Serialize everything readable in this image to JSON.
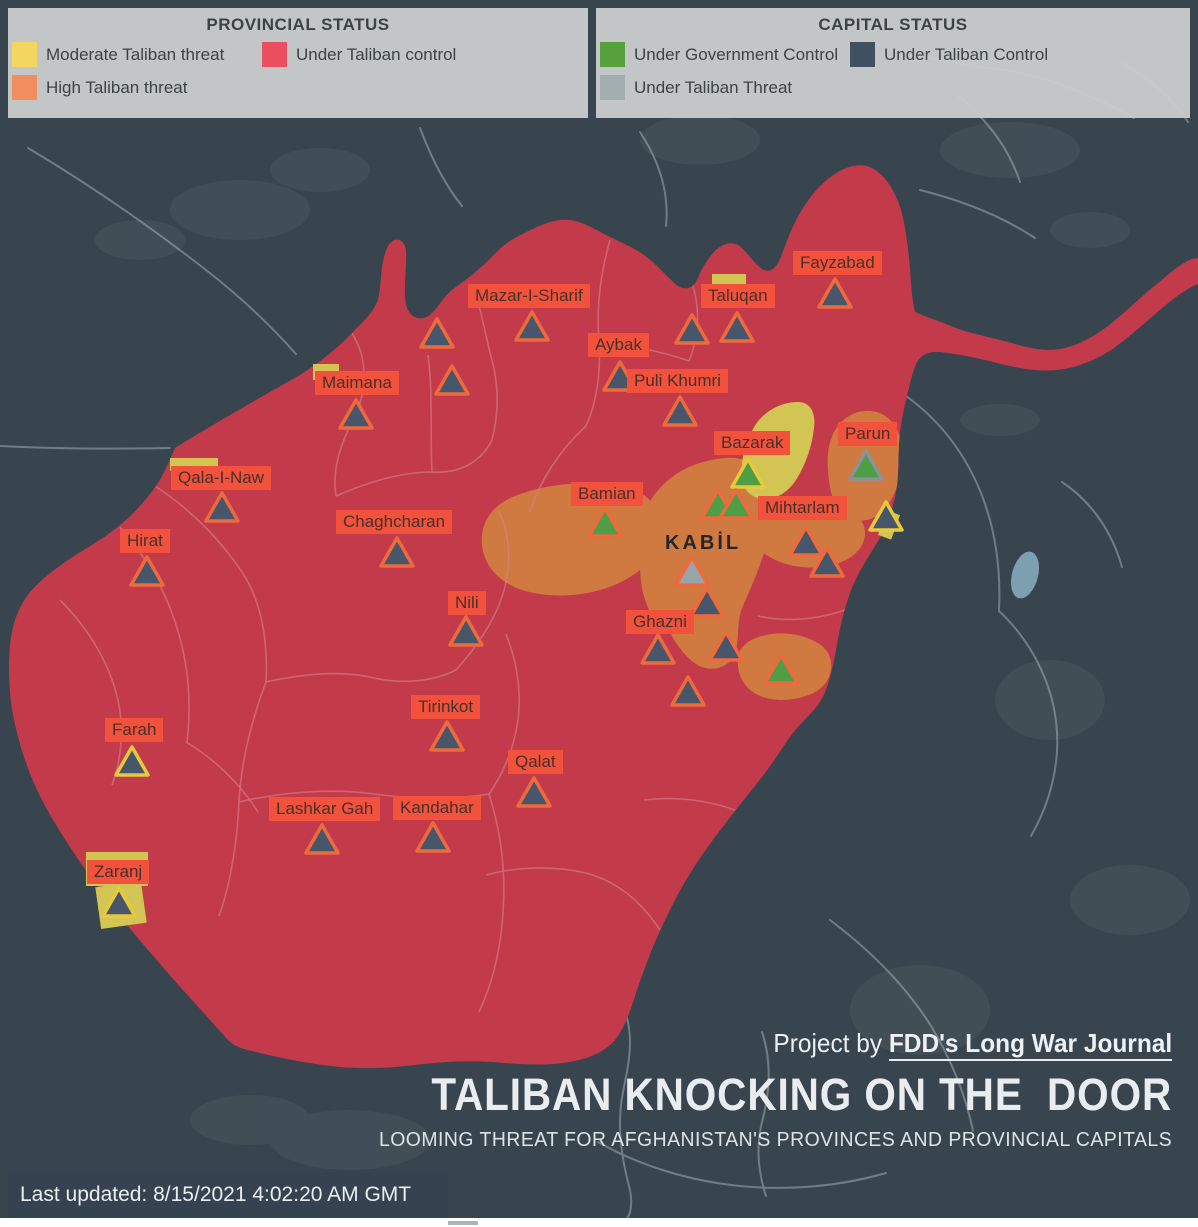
{
  "legend": {
    "provincial": {
      "title": "PROVINCIAL STATUS",
      "items": [
        {
          "label": "Moderate Taliban threat",
          "color": "#f3d65f"
        },
        {
          "label": "High Taliban threat",
          "color": "#f28d60"
        },
        {
          "label": "Under Taliban control",
          "color": "#e94f5e"
        }
      ]
    },
    "capital": {
      "title": "CAPITAL STATUS",
      "items": [
        {
          "label": "Under Government Control",
          "color": "#57a13d"
        },
        {
          "label": "Under Taliban Threat",
          "color": "#a3aeb1"
        },
        {
          "label": "Under Taliban Control",
          "color": "#3f5160"
        }
      ]
    }
  },
  "map": {
    "colors": {
      "background": "#39454e",
      "under_taliban_control_province": "#c33b4b",
      "high_threat_province": "#d07940",
      "moderate_threat_province": "#d2c553",
      "label_bg": "#f2513c",
      "label_text": "#46312b",
      "marker_taliban": "#47566a",
      "marker_government": "#4d9e45",
      "marker_threat": "#98a6ac",
      "outline_orange": "#ed6a3d",
      "outline_yellow": "#e7c93e",
      "outline_gray": "#8a9298"
    },
    "labels": [
      {
        "text": "Fayzabad",
        "x": 793,
        "y": 251
      },
      {
        "text": "Taluqan",
        "x": 701,
        "y": 284
      },
      {
        "text": "Mazar-I-Sharif",
        "x": 468,
        "y": 284
      },
      {
        "text": "Aybak",
        "x": 588,
        "y": 333
      },
      {
        "text": "Puli Khumri",
        "x": 627,
        "y": 369
      },
      {
        "text": "Maimana",
        "x": 315,
        "y": 371
      },
      {
        "text": "Bazarak",
        "x": 714,
        "y": 431
      },
      {
        "text": "Parun",
        "x": 838,
        "y": 422
      },
      {
        "text": "Qala-I-Naw",
        "x": 171,
        "y": 466
      },
      {
        "text": "Bamian",
        "x": 571,
        "y": 482
      },
      {
        "text": "Chaghcharan",
        "x": 336,
        "y": 510
      },
      {
        "text": "Mihtarlam",
        "x": 758,
        "y": 496
      },
      {
        "text": "Hirat",
        "x": 120,
        "y": 529
      },
      {
        "text": "KABİL",
        "x": 665,
        "y": 533,
        "plain": true
      },
      {
        "text": "Nili",
        "x": 448,
        "y": 591
      },
      {
        "text": "Ghazni",
        "x": 626,
        "y": 610
      },
      {
        "text": "Tirinkot",
        "x": 411,
        "y": 695
      },
      {
        "text": "Farah",
        "x": 105,
        "y": 718
      },
      {
        "text": "Qalat",
        "x": 508,
        "y": 750
      },
      {
        "text": "Lashkar Gah",
        "x": 269,
        "y": 797
      },
      {
        "text": "Kandahar",
        "x": 393,
        "y": 796
      },
      {
        "text": "Zaranj",
        "x": 87,
        "y": 860
      }
    ],
    "markers": [
      {
        "id": "fayzabad",
        "x": 835,
        "y": 278,
        "status": "taliban",
        "outline": "orange"
      },
      {
        "id": "capital-marker-1",
        "x": 692,
        "y": 314,
        "status": "taliban",
        "outline": "orange"
      },
      {
        "id": "taluqan",
        "x": 737,
        "y": 312,
        "status": "taliban",
        "outline": "orange"
      },
      {
        "id": "mazar-i-sharif",
        "x": 532,
        "y": 311,
        "status": "taliban",
        "outline": "orange"
      },
      {
        "id": "capital-marker-2",
        "x": 437,
        "y": 318,
        "status": "taliban",
        "outline": "orange"
      },
      {
        "id": "capital-marker-3",
        "x": 452,
        "y": 365,
        "status": "taliban",
        "outline": "orange"
      },
      {
        "id": "aybak",
        "x": 620,
        "y": 361,
        "status": "taliban",
        "outline": "orange"
      },
      {
        "id": "puli-khumri",
        "x": 680,
        "y": 396,
        "status": "taliban",
        "outline": "orange"
      },
      {
        "id": "maimana",
        "x": 356,
        "y": 399,
        "status": "taliban",
        "outline": "orange"
      },
      {
        "id": "qala-i-naw",
        "x": 222,
        "y": 492,
        "status": "taliban",
        "outline": "orange"
      },
      {
        "id": "hirat",
        "x": 147,
        "y": 556,
        "status": "taliban",
        "outline": "orange"
      },
      {
        "id": "chaghcharan",
        "x": 397,
        "y": 537,
        "status": "taliban",
        "outline": "orange"
      },
      {
        "id": "bamian",
        "x": 605,
        "y": 507,
        "status": "government",
        "outline": "orange"
      },
      {
        "id": "bazarak",
        "x": 748,
        "y": 458,
        "status": "government",
        "outline": "yellow"
      },
      {
        "id": "capital-marker-4",
        "x": 718,
        "y": 489,
        "status": "government",
        "outline": "orange"
      },
      {
        "id": "capital-marker-5",
        "x": 736,
        "y": 489,
        "status": "government",
        "outline": "orange"
      },
      {
        "id": "parun",
        "x": 866,
        "y": 450,
        "status": "government",
        "outline": "gray"
      },
      {
        "id": "kabil",
        "x": 692,
        "y": 556,
        "status": "threat",
        "outline": "orange"
      },
      {
        "id": "mihtarlam",
        "x": 806,
        "y": 526,
        "status": "taliban",
        "outline": "orange"
      },
      {
        "id": "capital-marker-6",
        "x": 827,
        "y": 547,
        "status": "taliban",
        "outline": "orange"
      },
      {
        "id": "capital-marker-7",
        "x": 886,
        "y": 501,
        "status": "taliban",
        "outline": "yellow"
      },
      {
        "id": "capital-marker-8",
        "x": 707,
        "y": 587,
        "status": "taliban",
        "outline": "orange"
      },
      {
        "id": "capital-marker-9",
        "x": 726,
        "y": 631,
        "status": "taliban",
        "outline": "orange"
      },
      {
        "id": "ghazni",
        "x": 658,
        "y": 634,
        "status": "taliban",
        "outline": "orange"
      },
      {
        "id": "capital-marker-10",
        "x": 688,
        "y": 676,
        "status": "taliban",
        "outline": "orange"
      },
      {
        "id": "capital-marker-11",
        "x": 781,
        "y": 654,
        "status": "government",
        "outline": "orange"
      },
      {
        "id": "nili",
        "x": 466,
        "y": 616,
        "status": "taliban",
        "outline": "orange"
      },
      {
        "id": "tirinkot",
        "x": 447,
        "y": 721,
        "status": "taliban",
        "outline": "orange"
      },
      {
        "id": "farah",
        "x": 132,
        "y": 746,
        "status": "taliban",
        "outline": "yellow"
      },
      {
        "id": "qalat",
        "x": 534,
        "y": 777,
        "status": "taliban",
        "outline": "orange"
      },
      {
        "id": "lashkar-gah",
        "x": 322,
        "y": 824,
        "status": "taliban",
        "outline": "orange"
      },
      {
        "id": "kandahar",
        "x": 433,
        "y": 822,
        "status": "taliban",
        "outline": "orange"
      },
      {
        "id": "zaranj",
        "x": 119,
        "y": 887,
        "status": "taliban",
        "outline": "yellow"
      }
    ],
    "patches": [
      {
        "x": 712,
        "y": 274,
        "w": 34,
        "h": 16,
        "r": 0
      },
      {
        "x": 313,
        "y": 364,
        "w": 26,
        "h": 16,
        "r": 0
      },
      {
        "x": 170,
        "y": 458,
        "w": 48,
        "h": 13,
        "r": 0
      },
      {
        "x": 86,
        "y": 852,
        "w": 62,
        "h": 34,
        "r": 0
      },
      {
        "x": 98,
        "y": 884,
        "w": 46,
        "h": 42,
        "r": -8
      },
      {
        "x": 882,
        "y": 512,
        "w": 14,
        "h": 26,
        "r": 20
      }
    ]
  },
  "footer": {
    "project_prefix": "Project by ",
    "project_name": "FDD's Long War Journal",
    "title": "TALIBAN KNOCKING ON THE  DOOR",
    "subtitle": "LOOMING THREAT FOR AFGHANISTAN'S PROVINCES AND PROVINCIAL CAPITALS",
    "last_updated": "Last updated: 8/15/2021 4:02:20 AM GMT"
  }
}
